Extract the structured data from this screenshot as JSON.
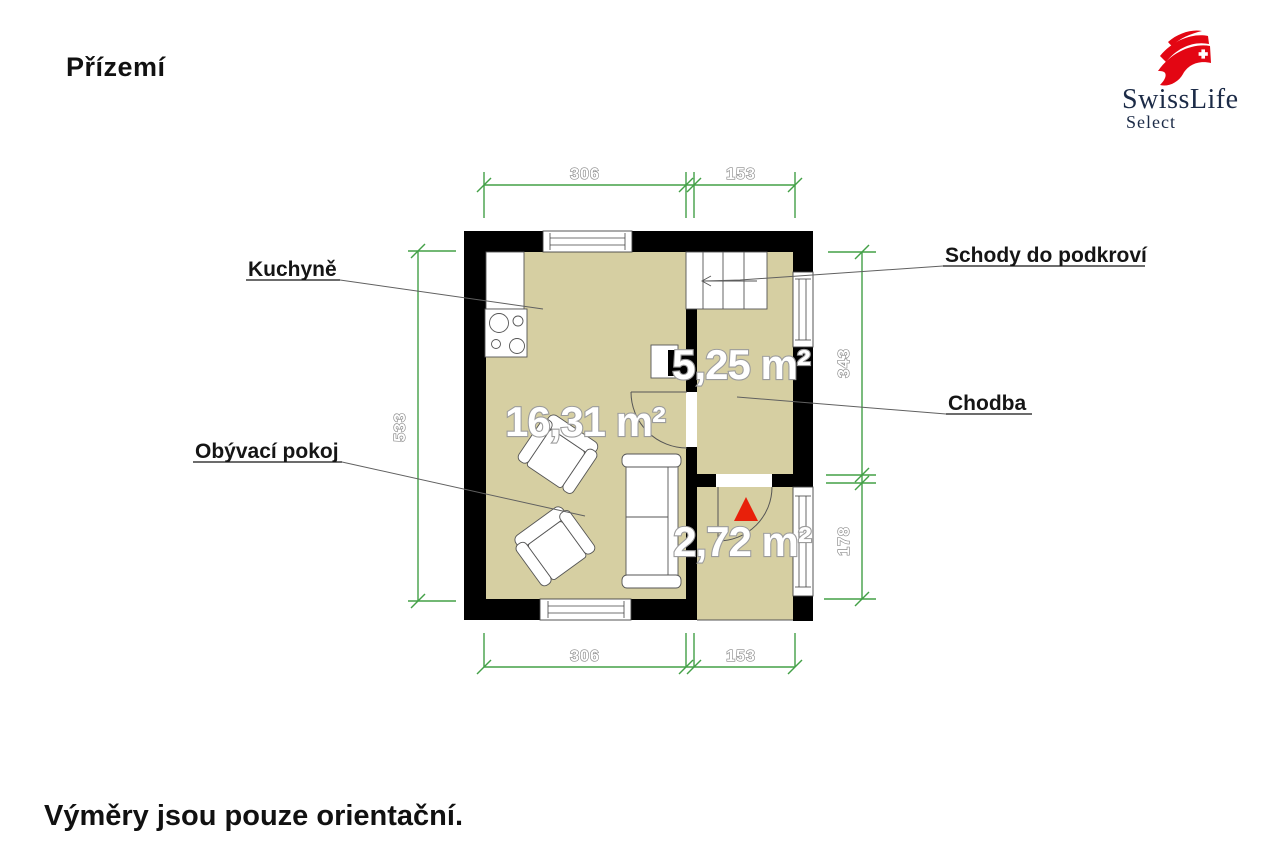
{
  "page": {
    "title": "Přízemí",
    "footer_note": "Výměry jsou pouze orientační."
  },
  "logo": {
    "brand": "SwissLife",
    "product": "Select",
    "brand_red": "#e30613",
    "brand_navy": "#1c2b47"
  },
  "floor_plan": {
    "room_labels": {
      "kitchen": "Kuchyně",
      "living_room": "Obývací pokoj",
      "stairs": "Schody do podkroví",
      "hallway": "Chodba"
    },
    "areas": {
      "living_room": "16,31 m²",
      "hallway": "5,25 m²",
      "entry": "2,72 m²"
    },
    "dimensions_cm": {
      "top_left": "306",
      "top_right": "153",
      "bottom_left": "306",
      "bottom_right": "153",
      "left_side": "533",
      "right_upper": "343",
      "right_lower": "178"
    },
    "colors": {
      "floor": "#d6cfa2",
      "wall": "#000000",
      "dimension_line": "#43a047",
      "entry_marker": "#e8200a"
    }
  }
}
